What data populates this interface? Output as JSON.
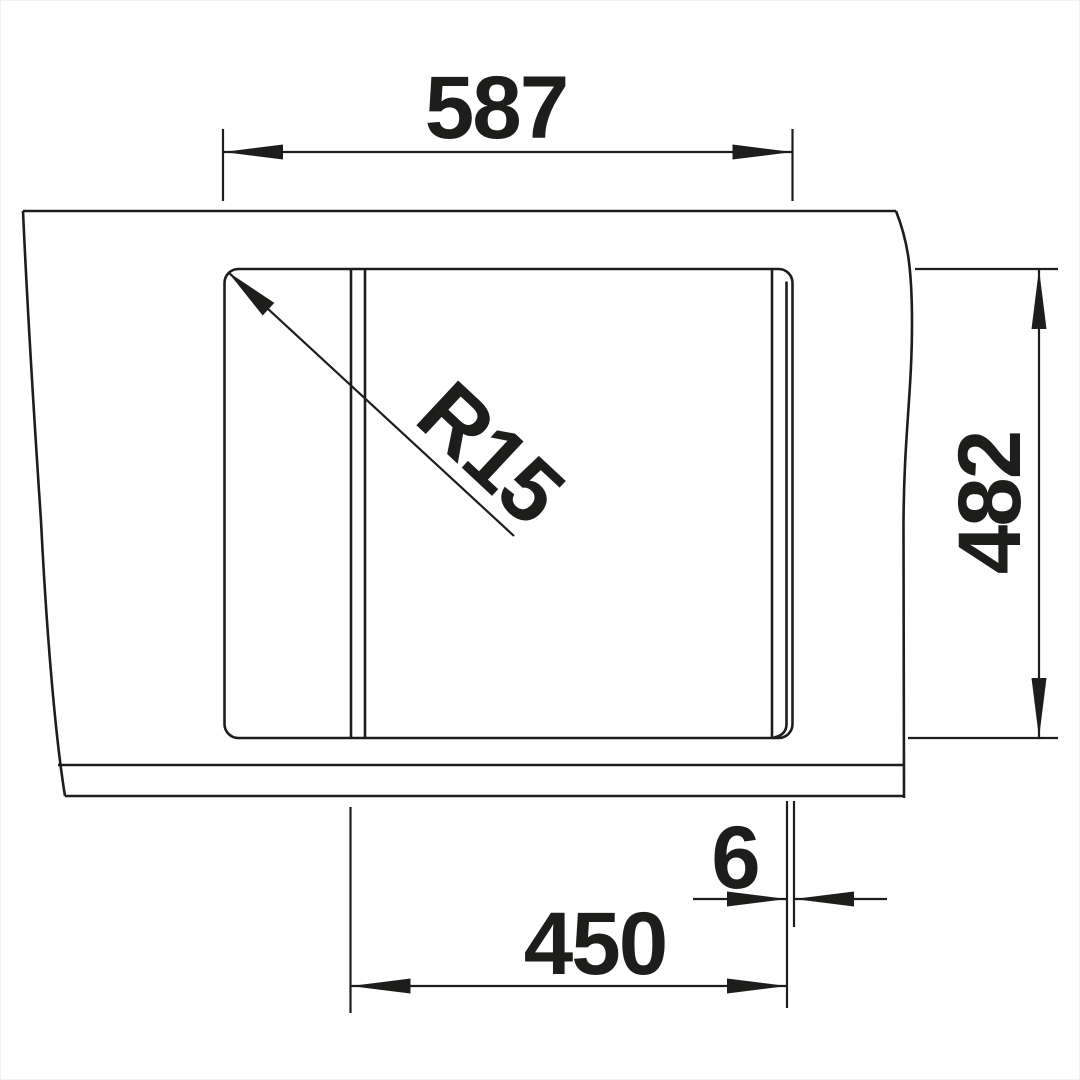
{
  "drawing": {
    "labels": {
      "width_total": "587",
      "depth_total": "482",
      "bowl_width": "450",
      "edge_offset": "6",
      "corner_radius": "R15"
    },
    "colors": {
      "line": "#1d1d1b",
      "background": "#ffffff"
    }
  }
}
